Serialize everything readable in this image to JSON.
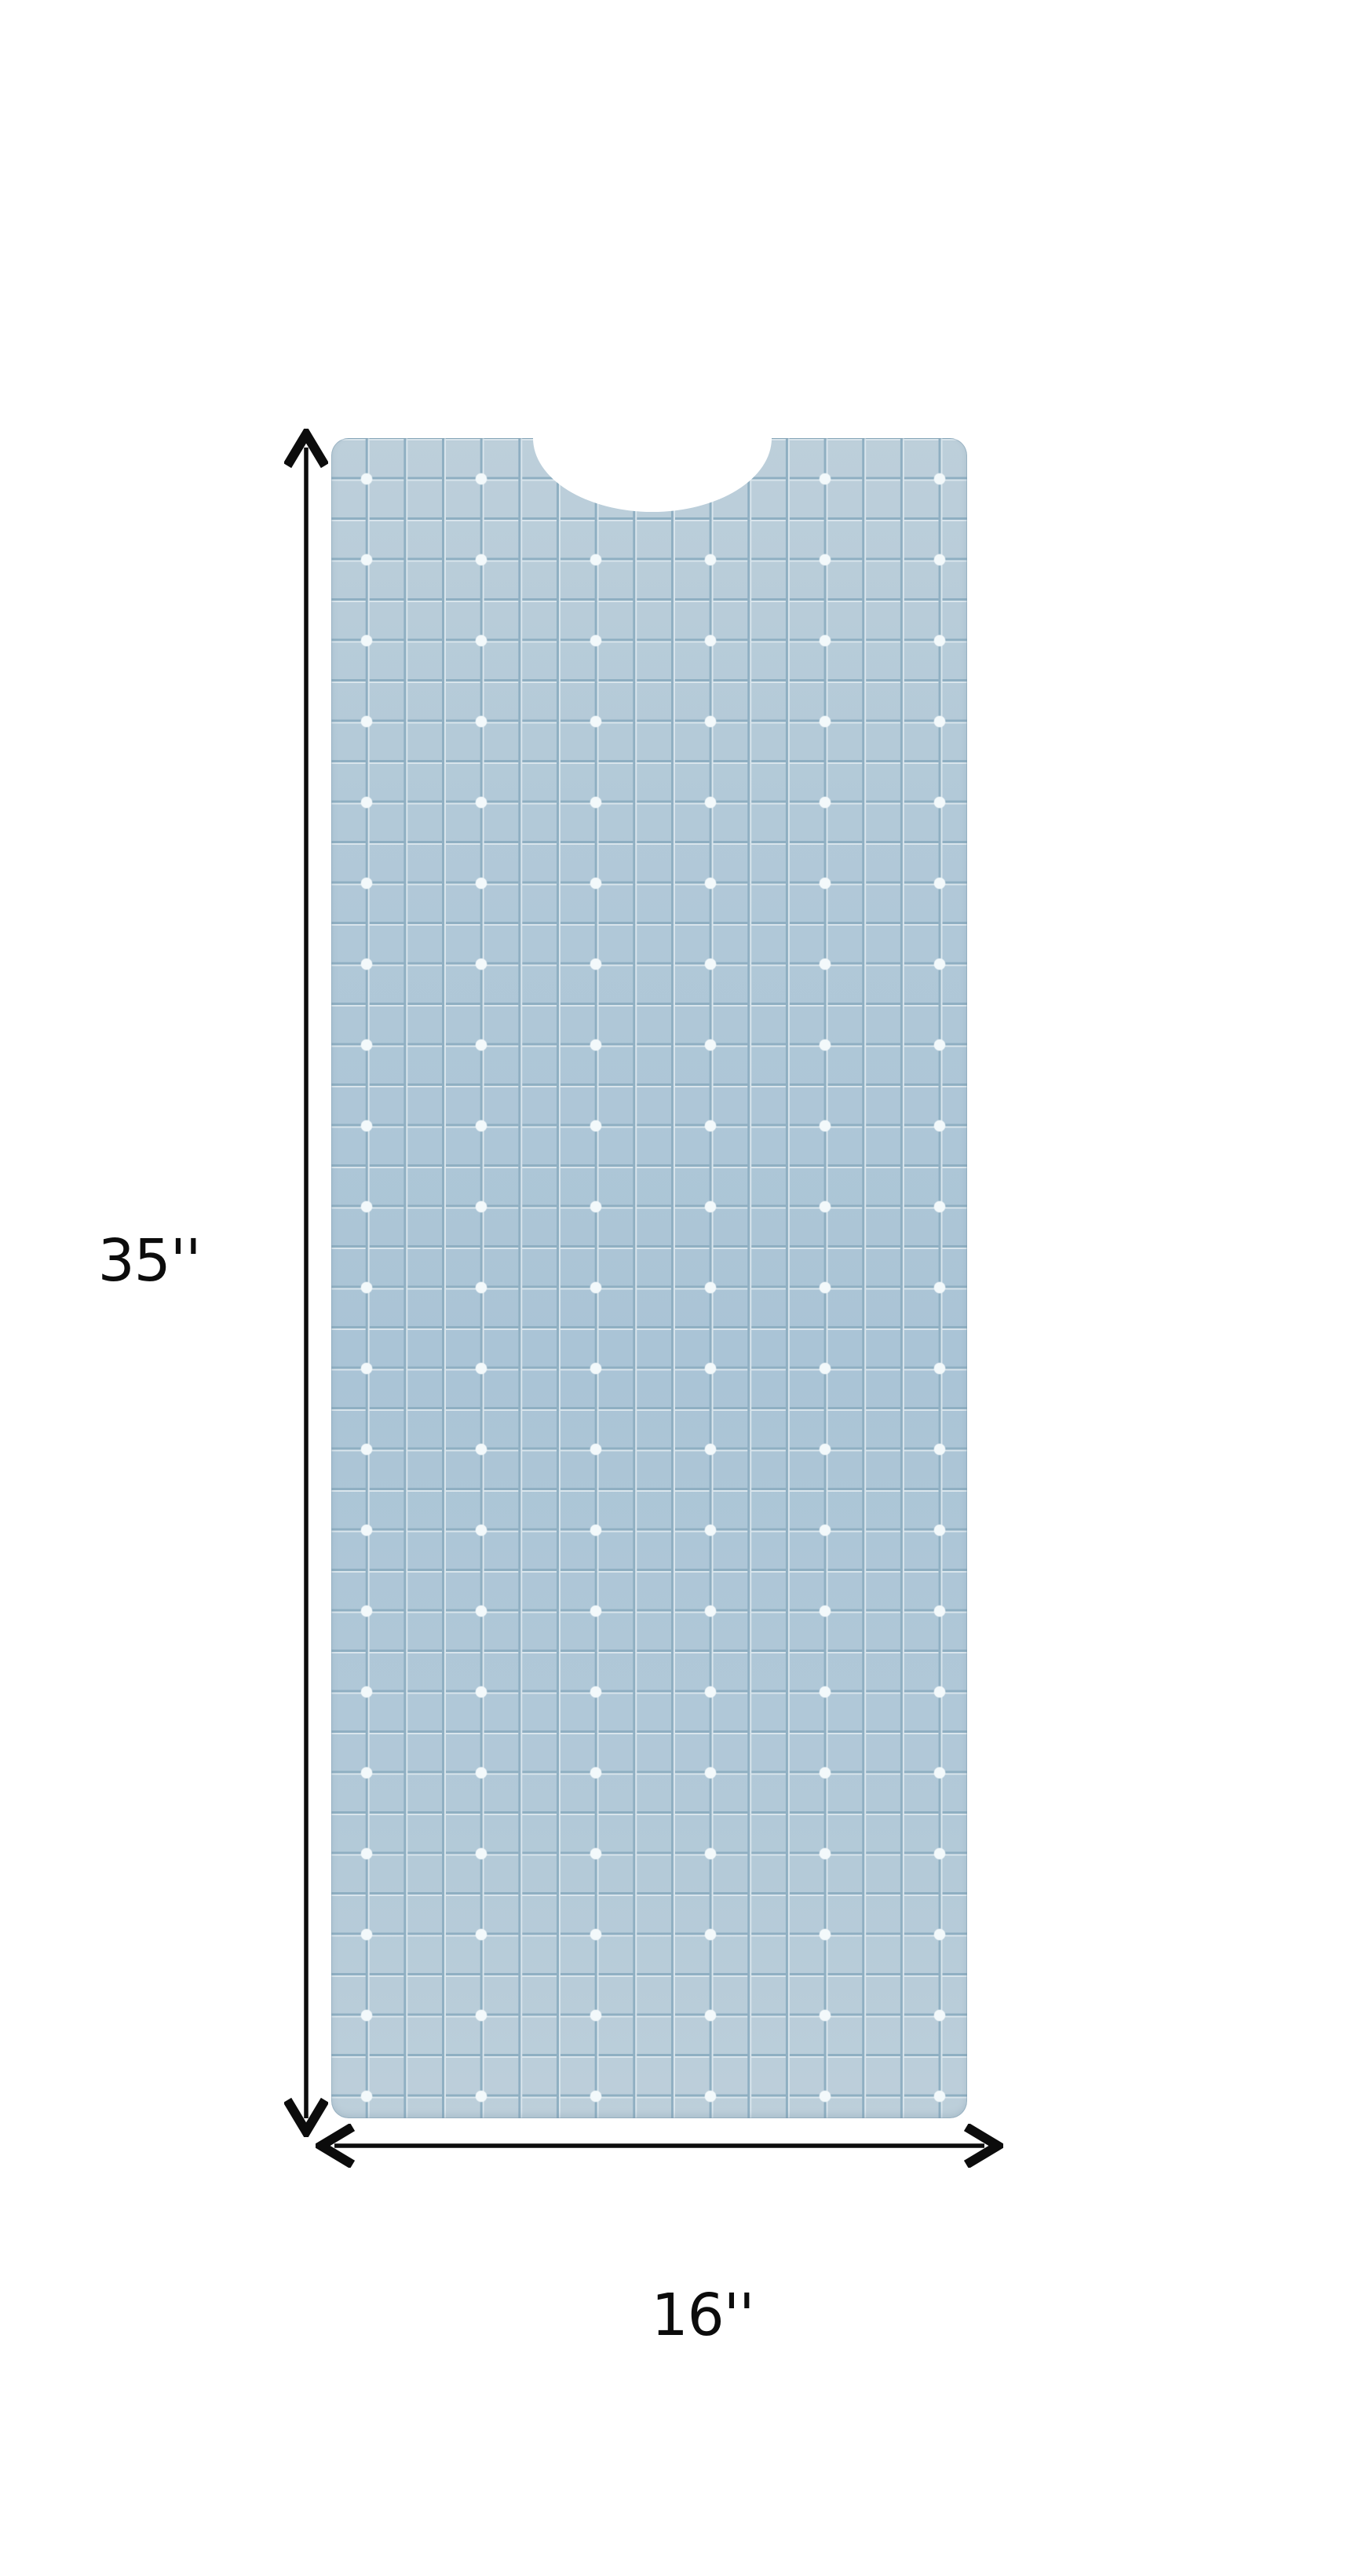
{
  "dimensions": {
    "height_label": "35''",
    "width_label": "16''"
  },
  "colors": {
    "background": "#ffffff",
    "mat_base": "#b2c9d8",
    "mat_base_light": "#bdcfda",
    "mat_base_deep": "#aac4d6",
    "grid_dark": "#8fafc2",
    "grid_light": "#d9e5ec",
    "dot": "#f3f9fb",
    "ink": "#0c0c0c"
  }
}
